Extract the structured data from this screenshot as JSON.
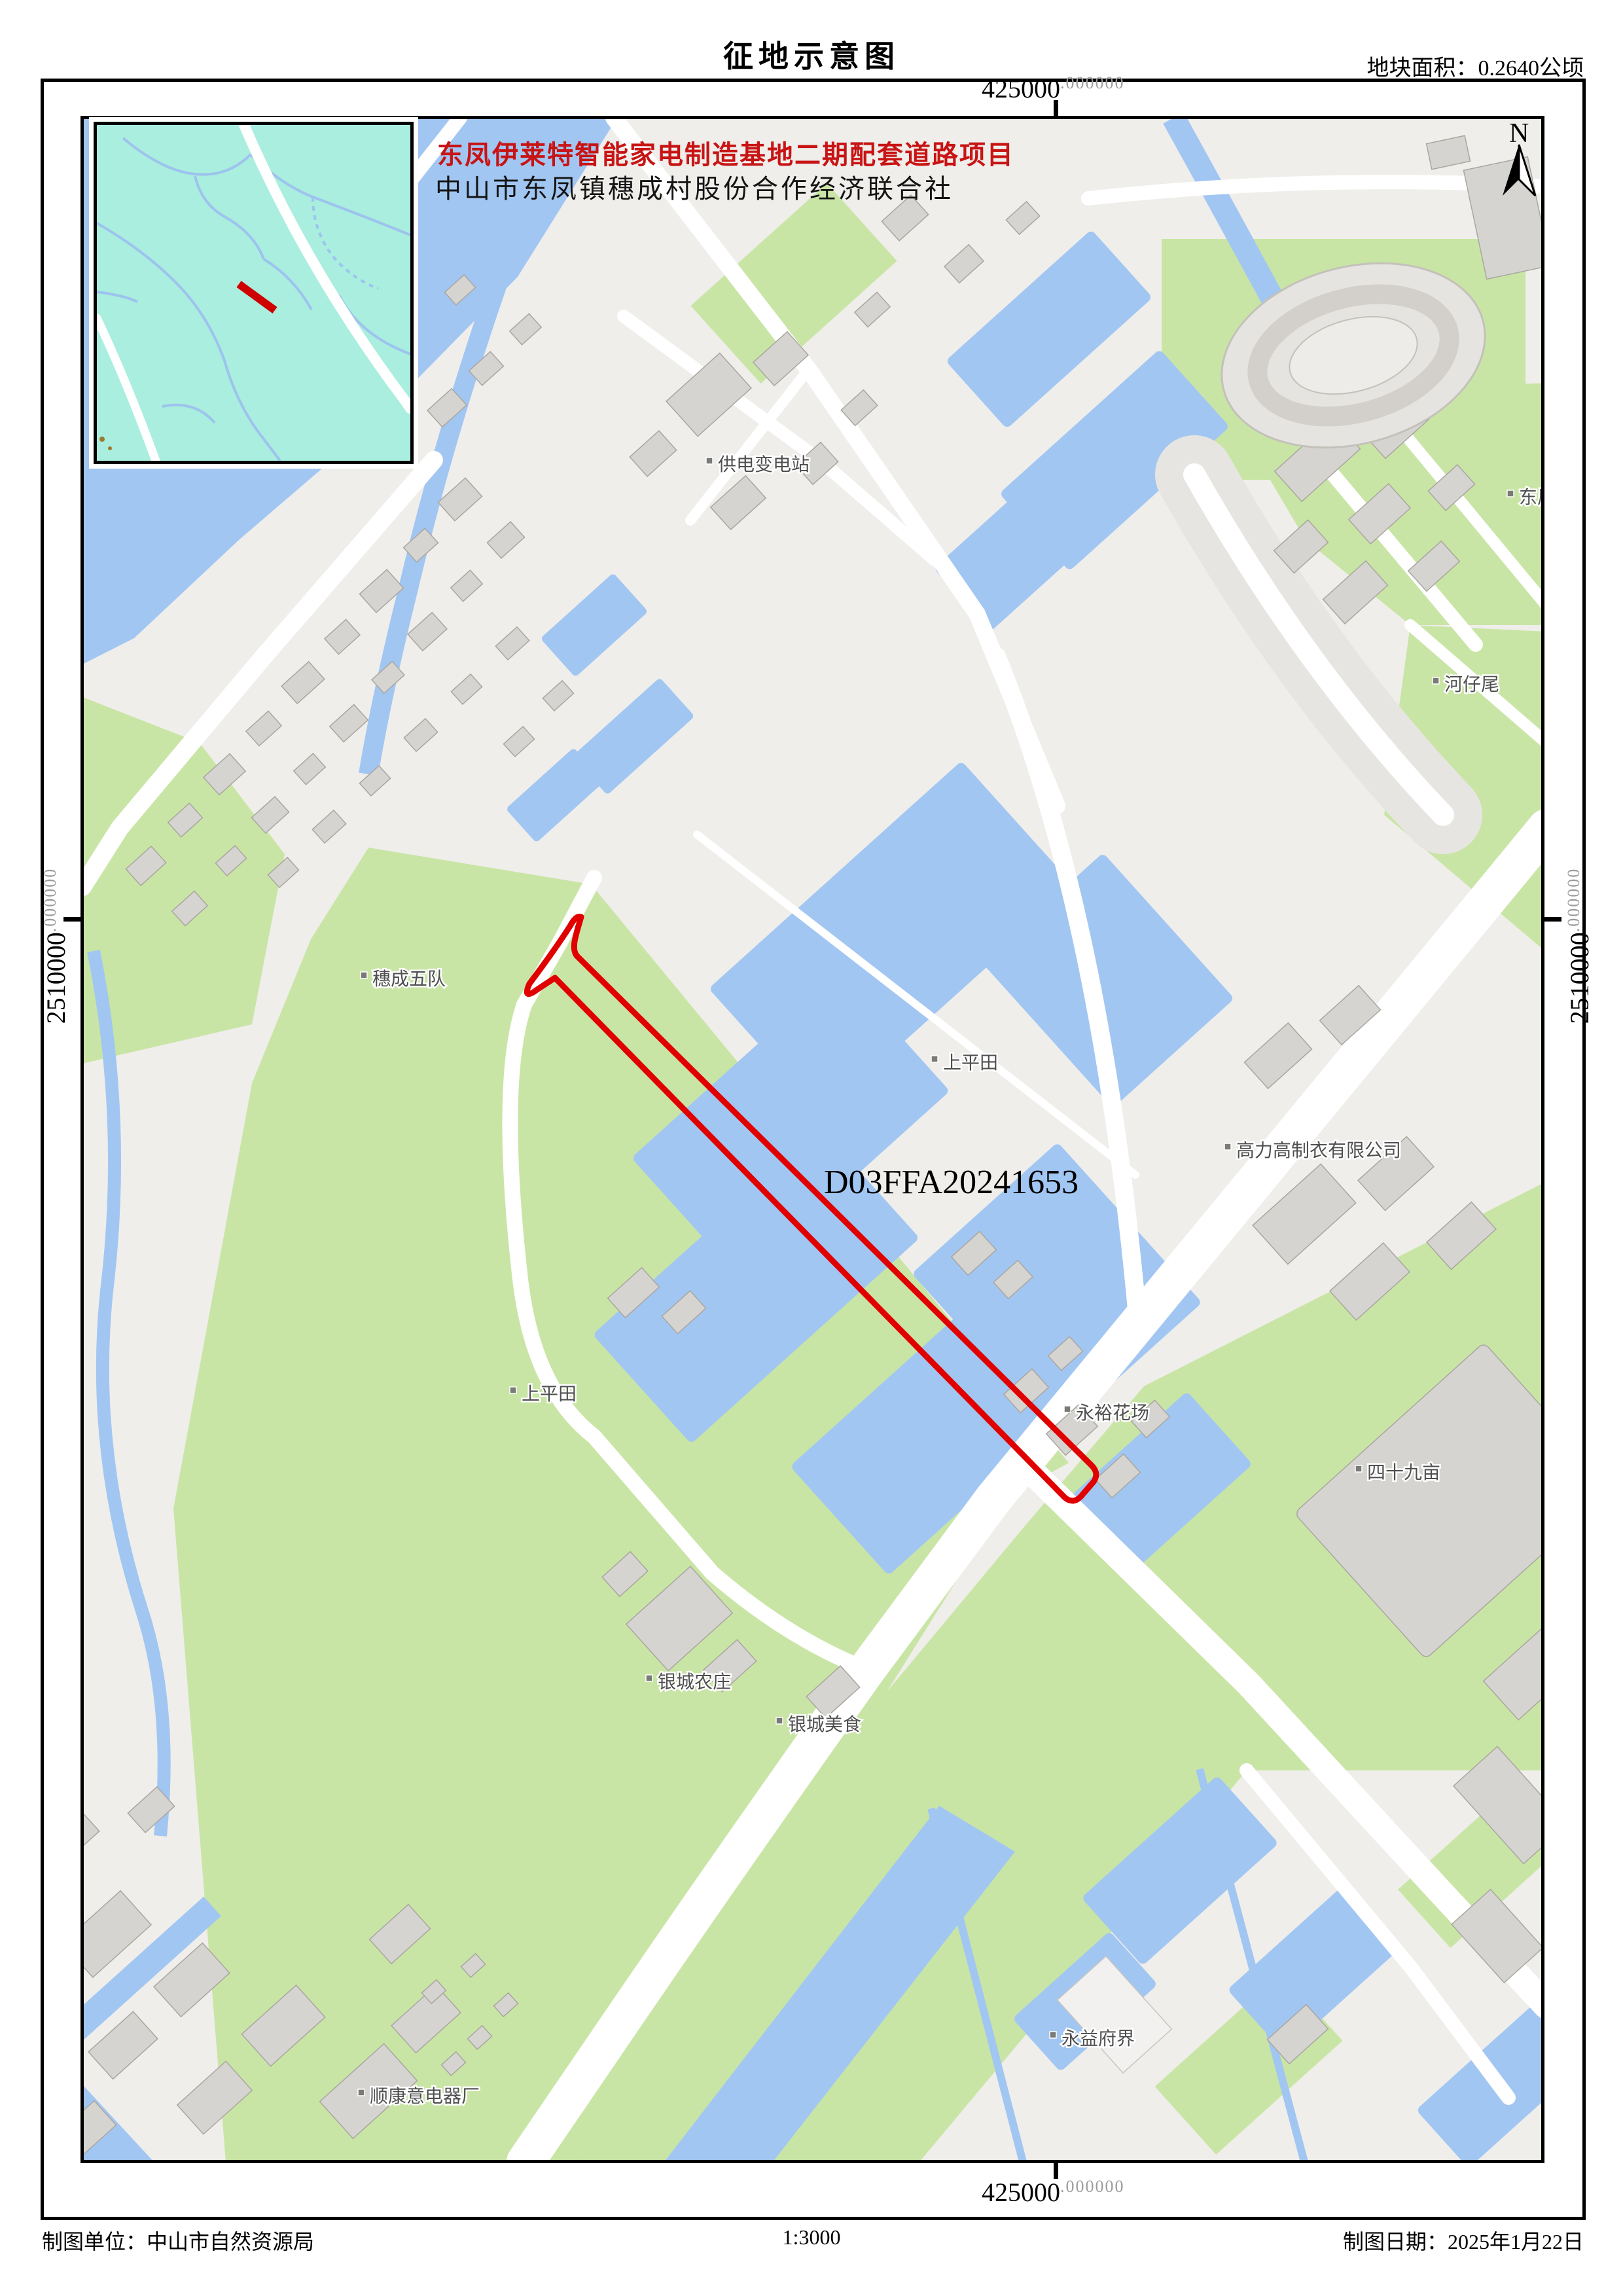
{
  "page": {
    "title": "征地示意图",
    "area_note": "地块面积：0.2640公顷"
  },
  "map": {
    "project_title": "东凤伊莱特智能家电制造基地二期配套道路项目",
    "project_subtitle": "中山市东凤镇穗成村股份合作经济联合社",
    "parcel_id": "D03FFA20241653",
    "north_label": "N",
    "labels": [
      {
        "text": "供电变电站"
      },
      {
        "text": "穗成五队"
      },
      {
        "text": "上平田"
      },
      {
        "text": "上平田"
      },
      {
        "text": "永裕花场"
      },
      {
        "text": "河仔尾"
      },
      {
        "text": "东凤"
      },
      {
        "text": "高力高制衣有限公司"
      },
      {
        "text": "四十九亩"
      },
      {
        "text": "银城农庄"
      },
      {
        "text": "银城美食"
      },
      {
        "text": "永益府界"
      },
      {
        "text": "顺康意电器厂"
      }
    ]
  },
  "grid": {
    "x": {
      "main": "425000",
      "dec": ".000000"
    },
    "y": {
      "main": "2510000",
      "dec": ".000000"
    }
  },
  "footer": {
    "agency": "制图单位：中山市自然资源局",
    "scale": "1:3000",
    "date": "制图日期：2025年1月22日"
  },
  "colors": {
    "parcel_red": "#e00000",
    "water_blue": "#a2c6f2",
    "green_land": "#c9e5a5",
    "inset_teal": "#a9eede",
    "building_gray": "#d6d4d0"
  }
}
